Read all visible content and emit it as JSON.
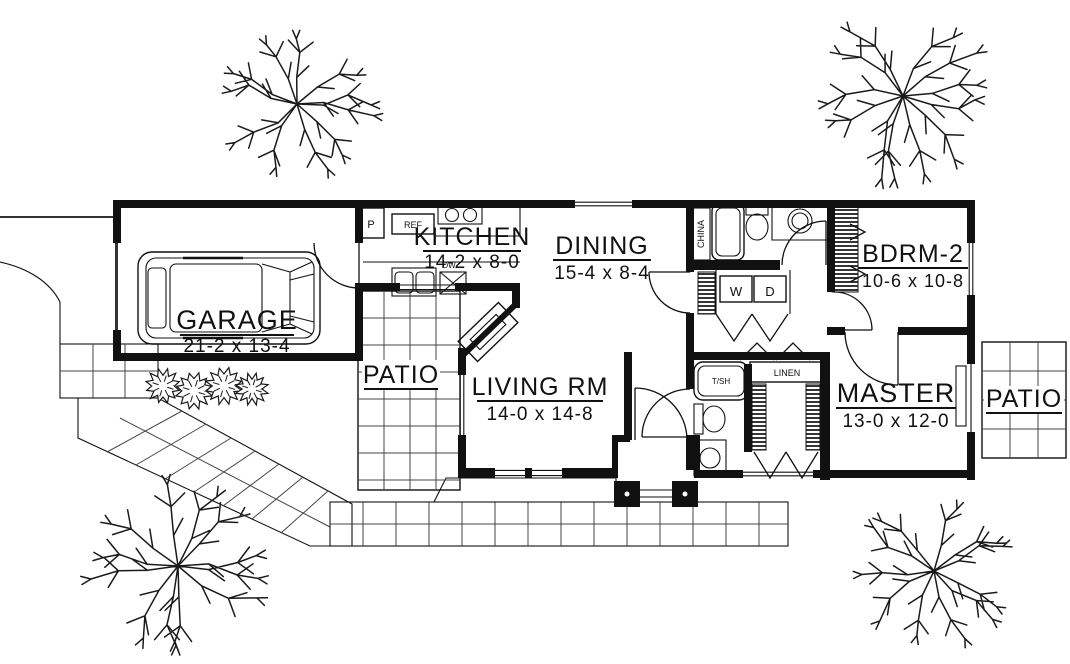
{
  "drawing_type": "house floor plan",
  "rooms": {
    "garage": {
      "label": "GARAGE",
      "dims": "21-2 x 13-4"
    },
    "kitchen": {
      "label": "KITCHEN",
      "dims": "14-2 x 8-0"
    },
    "dining": {
      "label": "DINING",
      "dims": "15-4 x 8-4"
    },
    "bedroom2": {
      "label": "BDRM-2",
      "dims": "10-6 x 10-8"
    },
    "living_room": {
      "label": "LIVING RM",
      "dims": "14-0 x 14-8"
    },
    "master": {
      "label": "MASTER",
      "dims": "13-0 x 12-0"
    },
    "patio_left": {
      "label": "PATIO"
    },
    "patio_right": {
      "label": "PATIO"
    }
  },
  "fixtures": {
    "pantry": "P",
    "refrigerator": "REF",
    "dishwasher": "DW",
    "china_cabinet": "CHINA",
    "washer": "W",
    "dryer": "D",
    "tub_shower": "T/SH",
    "linen": "LINEN"
  },
  "colors": {
    "ink": "#000000",
    "paper": "#ffffff"
  }
}
